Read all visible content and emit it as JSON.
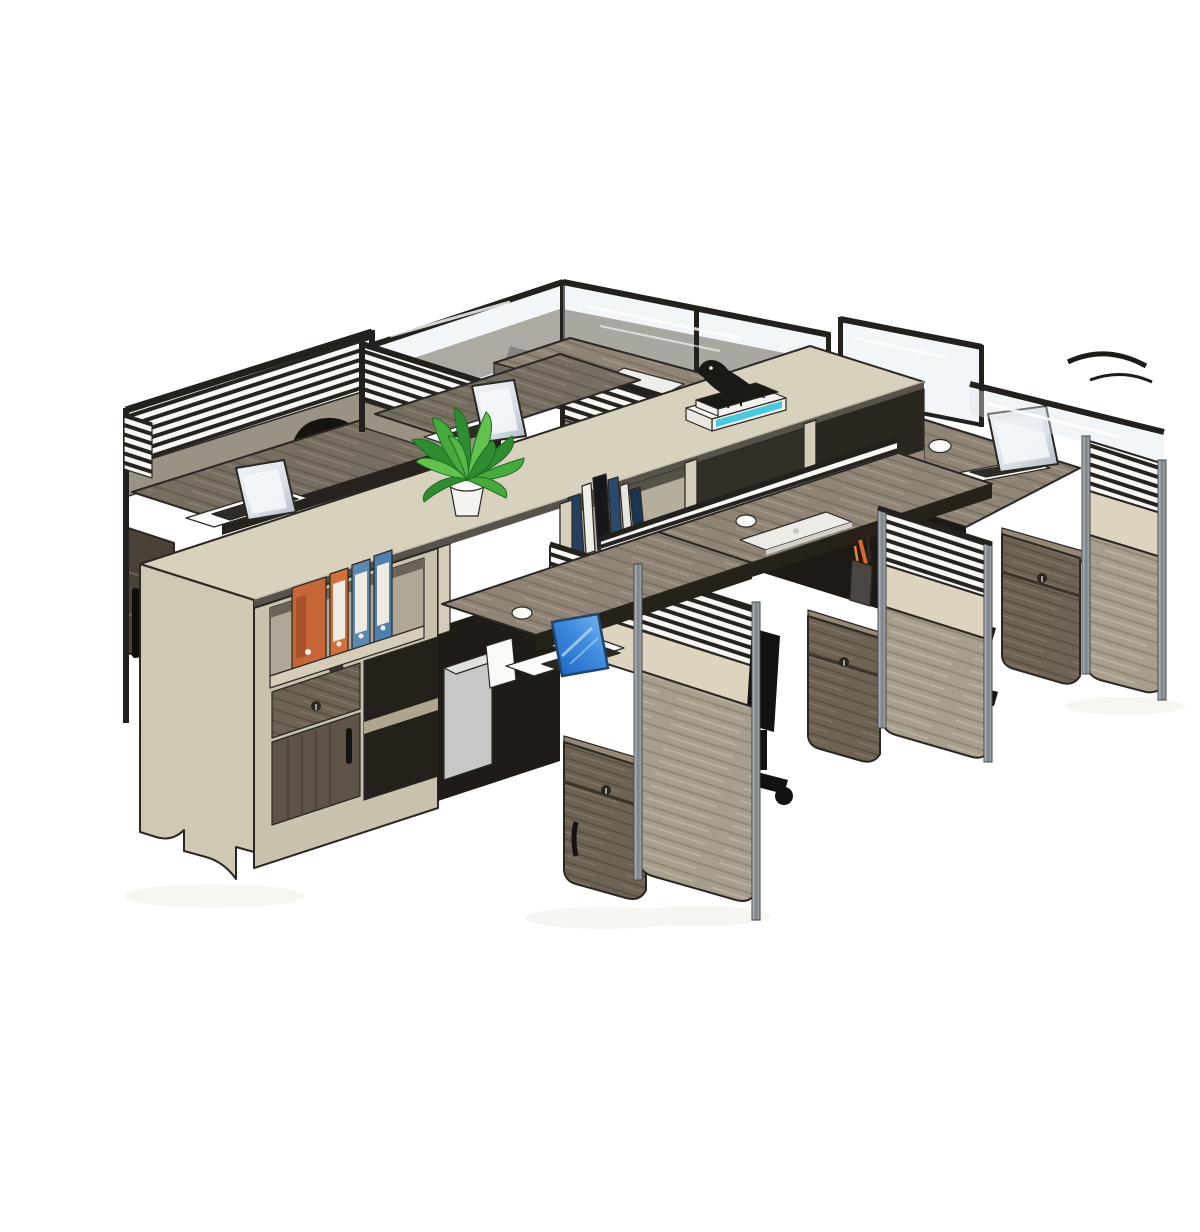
{
  "scene": {
    "type": "product-photo",
    "description": "Isometric product render of a six-person modular office cubicle workstation cluster: a long beige storage spine with open shelves, binders and books, wood-grain desks with louvered privacy partitions topped by glass, open silver laptops, one laptop with a blue screen, one closed white laptop, a green potted plant, a black bird figurine on stacked books, mobile pedestal drawer cabinets and black office chairs on a plain white background.",
    "background_color": "#FFFFFF"
  },
  "palette": {
    "spine_top_beige": "#D8D1BE",
    "spine_face_beige": "#C9C2AF",
    "partition_beige_band": "#DDD3BE",
    "desk_wood": "#8F8476",
    "desk_wood_dark": "#776E62",
    "partition_wood": "#A89E8D",
    "pedestal_wood": "#6E6254",
    "louver_stripe_dark": "#262420",
    "louver_background": "#F8F7F3",
    "frame_black": "#23211d",
    "frame_aluminum": "#9AA0A6",
    "under_desk_shadow": "#211E19",
    "chair_black": "#151310",
    "plant_green": "#3FA238",
    "pot_white": "#F4F3EF",
    "binder_orange": "#C66536",
    "binder_blue": "#5D88B2",
    "laptop_silver": "#ECEBE7",
    "laptop_screen_gray": "#EDF0F3",
    "laptop_screen_blue": "#2F7FD4",
    "book_navy": "#24405E",
    "book_cyan": "#49C9DE",
    "cpu_box_gray": "#C7C9C6",
    "glass_tint": "#DEE6EB"
  },
  "objects": {
    "workstations": 6,
    "open_laptops": 4,
    "closed_laptops": 1,
    "blue_screen_laptops": 1,
    "potted_plants": 1,
    "bird_figurines": 1,
    "binders": 4,
    "binder_colors": [
      "orange",
      "orange",
      "blue",
      "blue"
    ],
    "books_on_shelf": 6,
    "stacked_books_under_bird": 2,
    "pedestal_cabinets": 5,
    "office_chairs": 3,
    "pen_cups": 1,
    "computer_mice": 3,
    "white_desk_mats": 1,
    "louvered_partitions": 7,
    "glass_partitions": 4
  }
}
